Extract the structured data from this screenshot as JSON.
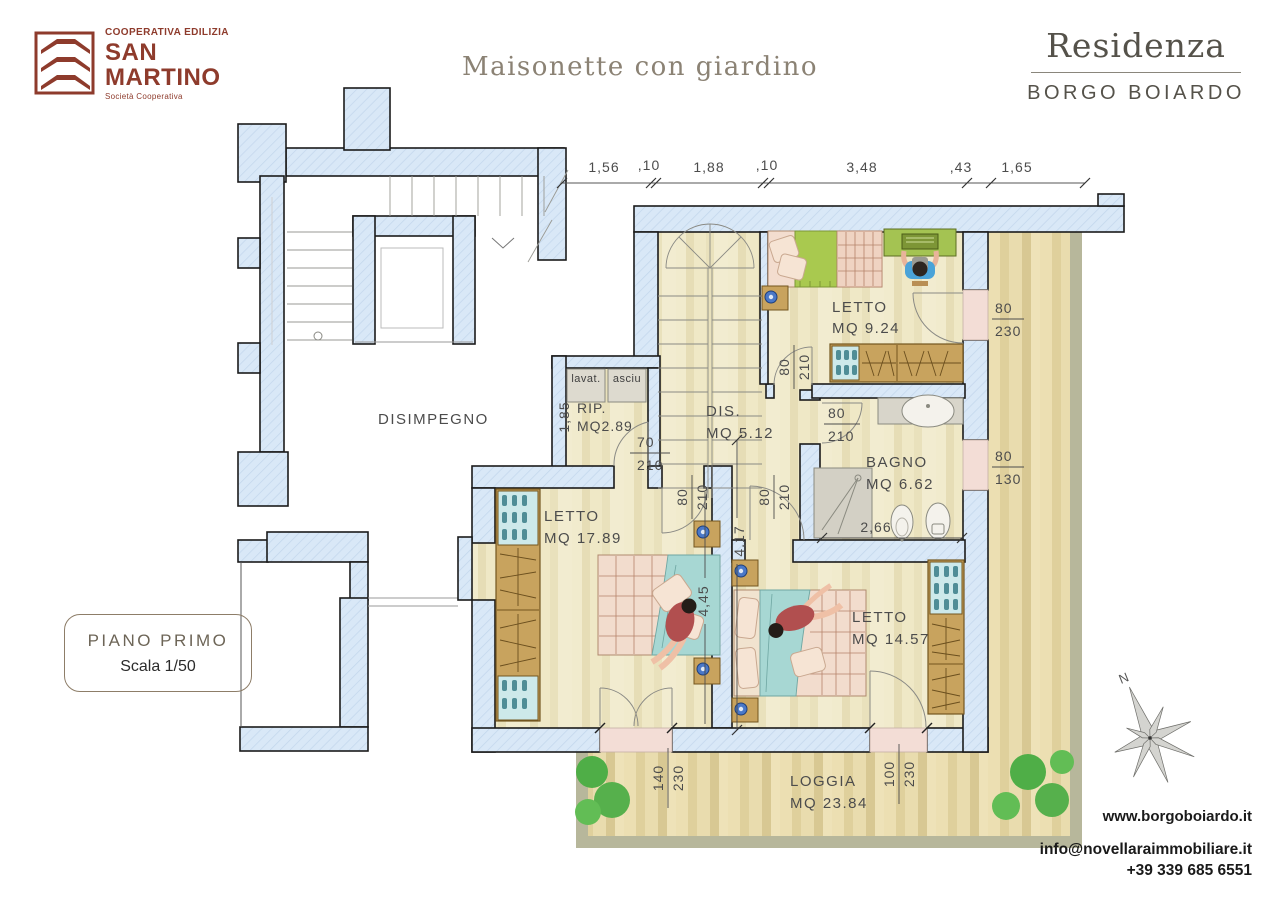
{
  "logo": {
    "line1": "COOPERATIVA EDILIZIA",
    "line2": "SAN",
    "line3": "MARTINO",
    "line4": "Società Cooperativa"
  },
  "title": "Maisonette con giardino",
  "brand": {
    "name": "Residenza",
    "location": "BORGO BOIARDO"
  },
  "badge": {
    "floor": "PIANO PRIMO",
    "scale": "Scala 1/50"
  },
  "footer": {
    "website": "www.borgoboiardo.it",
    "email": "info@novellaraimmobiliare.it",
    "phone": "+39 339 685 6551"
  },
  "compass": {
    "label": "N"
  },
  "rooms": {
    "disimpegno": {
      "name": "DISIMPEGNO"
    },
    "letto1": {
      "name": "LETTO",
      "area": "MQ 9.24"
    },
    "rip": {
      "name": "RIP.",
      "area": "MQ2.89"
    },
    "dis": {
      "name": "DIS.",
      "area": "MQ 5.12"
    },
    "bagno": {
      "name": "BAGNO",
      "area": "MQ 6.62"
    },
    "letto2": {
      "name": "LETTO",
      "area": "MQ 17.89"
    },
    "letto3": {
      "name": "LETTO",
      "area": "MQ 14.57"
    },
    "loggia": {
      "name": "LOGGIA",
      "area": "MQ 23.84"
    }
  },
  "appliances": {
    "washer": "lavat.",
    "dryer": "asciu"
  },
  "top_dims": [
    "1,56",
    ",10",
    "1,88",
    ",10",
    "3,48",
    ",43",
    "1,65"
  ],
  "dims": {
    "letto1_window": {
      "w": "80",
      "h": "230"
    },
    "letto1_door": {
      "w": "80",
      "h": "210"
    },
    "bagno_door": {
      "w": "80",
      "h": "210"
    },
    "bagno_window": {
      "w": "80",
      "h": "130"
    },
    "rip_door": {
      "w": "70",
      "h": "210"
    },
    "letto2_door": {
      "w": "80",
      "h": "210"
    },
    "letto3_door": {
      "w": "80",
      "h": "210"
    },
    "loggia_door_left": {
      "w": "140",
      "h": "230"
    },
    "loggia_door_right": {
      "w": "100",
      "h": "230"
    },
    "rip_depth": "1,85",
    "bagno_width": "2,66",
    "letto2_length": "4,45",
    "corridor_length": "4,17"
  },
  "colors": {
    "wall": "#d9e8f7",
    "logo_red": "#8e3b2c",
    "brand_gray": "#55524a",
    "floor_cream": "#ece4c2",
    "loggia_wood": "#e6d9a8",
    "loggia_border": "#b7b79b",
    "threshold_pink": "#f3ddd6",
    "tree_green": "#56b04c"
  }
}
